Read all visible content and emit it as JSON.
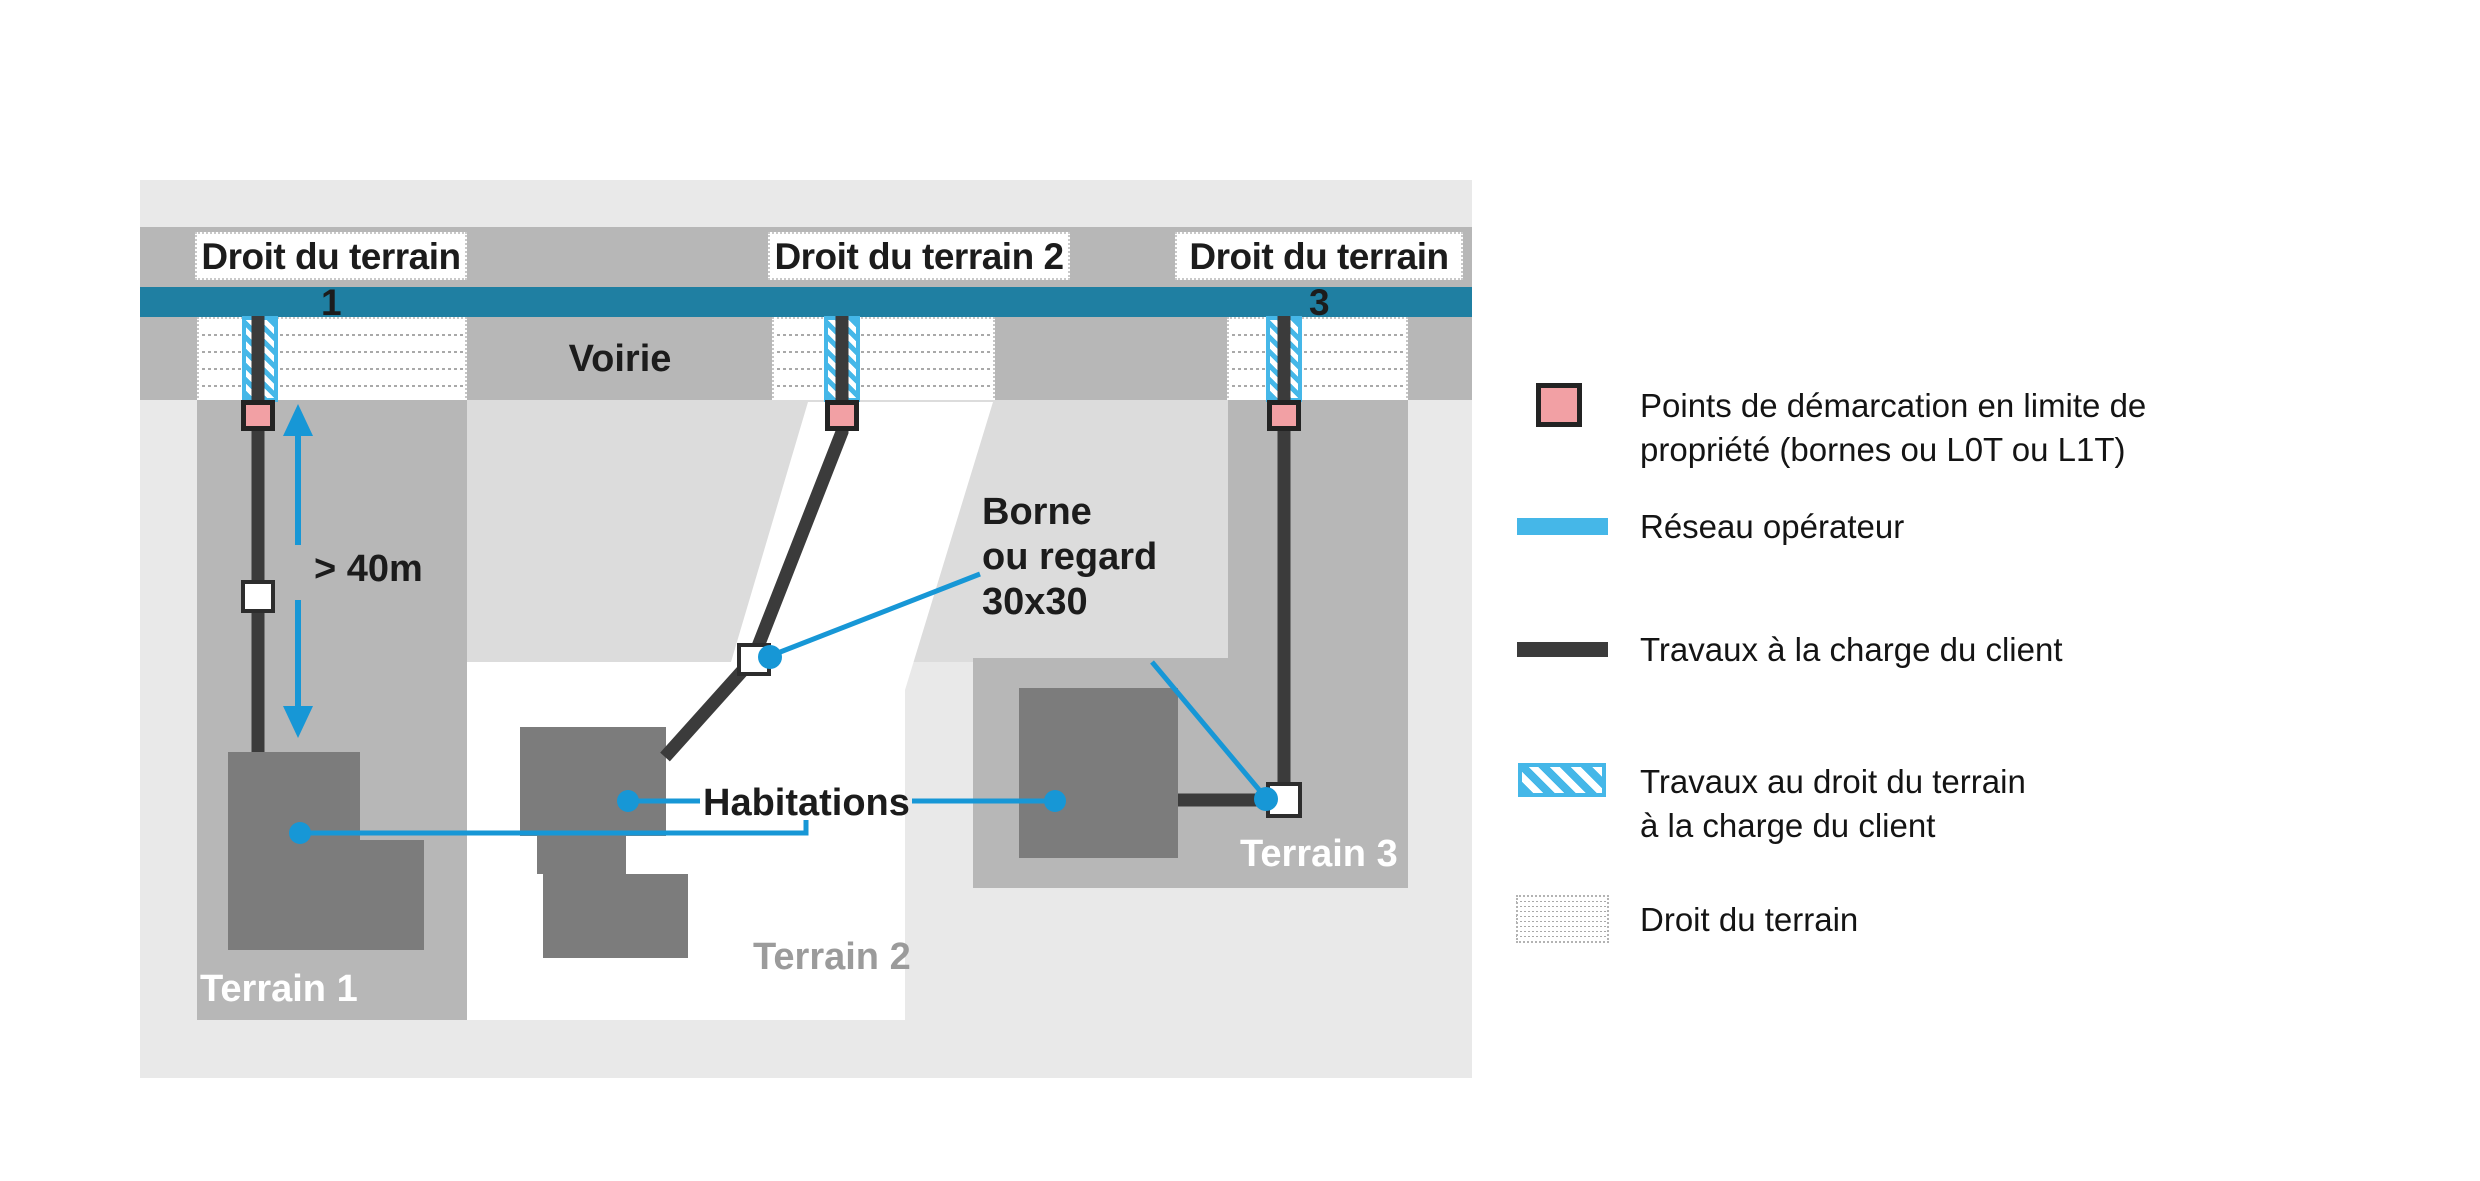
{
  "colors": {
    "panel-bg": "#e9e9e9",
    "band-gray": "#b7b7b7",
    "patch-gray": "#dcdcdc",
    "teal": "#1f7fa2",
    "operator-blue": "#45b7e8",
    "callout-blue": "#1797d6",
    "cable-dark": "#3b3b3b",
    "house-gray": "#7c7c7c",
    "demarcation-pink": "#f2a0a4",
    "terrain2-label-gray": "#9b9b9b"
  },
  "diagram": {
    "strip_labels": [
      {
        "label": "Droit du terrain 1"
      },
      {
        "label": "Droit du terrain 2"
      },
      {
        "label": "Droit du terrain 3"
      }
    ],
    "road_label": "Voirie",
    "distance_label": "> 40m",
    "terrain_labels": [
      "Terrain 1",
      "Terrain 2",
      "Terrain 3"
    ],
    "habitations_label": "Habitations",
    "borne_label_lines": [
      "Borne",
      "ou regard",
      "30x30"
    ]
  },
  "legend": {
    "items": [
      {
        "id": "demarcation",
        "swatch": "pink-square",
        "lines": [
          "Points de démarcation en limite de",
          "propriété (bornes ou L0T ou L1T)"
        ]
      },
      {
        "id": "reseau-operateur",
        "swatch": "blue-bar",
        "lines": [
          "Réseau opérateur"
        ]
      },
      {
        "id": "travaux-client",
        "swatch": "dark-bar",
        "lines": [
          "Travaux à la charge du client"
        ]
      },
      {
        "id": "travaux-droit-terrain",
        "swatch": "hatched-square",
        "lines": [
          "Travaux au droit du terrain",
          "à la charge du client"
        ]
      },
      {
        "id": "droit-terrain",
        "swatch": "dotted-square",
        "lines": [
          "Droit du terrain"
        ]
      }
    ]
  }
}
